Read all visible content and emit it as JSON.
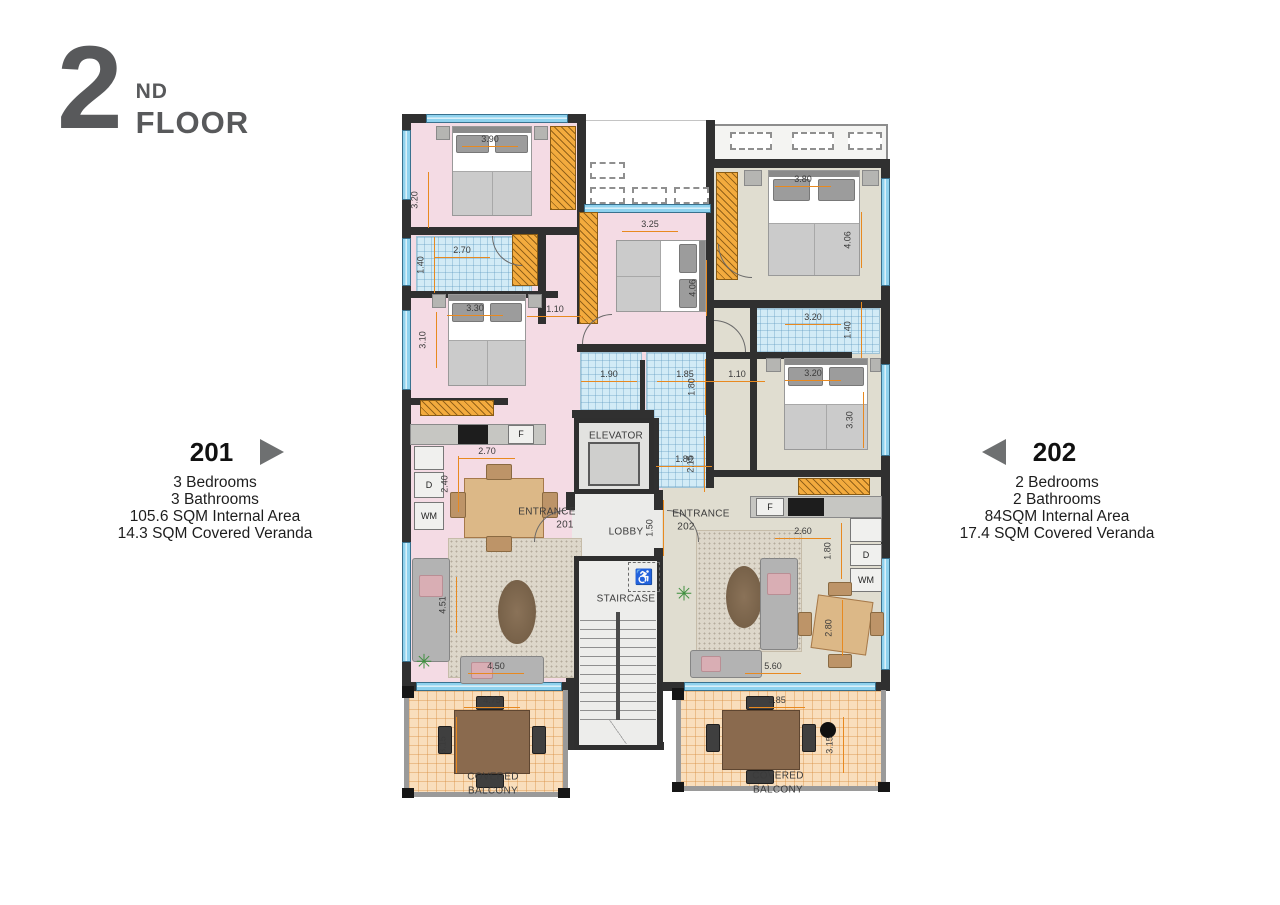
{
  "header": {
    "number": "2",
    "suffix": "ND",
    "word": "FLOOR"
  },
  "unit_left": {
    "number": "201",
    "bedrooms": "3 Bedrooms",
    "bathrooms": "3 Bathrooms",
    "internal": "105.6 SQM Internal Area",
    "veranda": "14.3 SQM Covered Veranda"
  },
  "unit_right": {
    "number": "202",
    "bedrooms": "2 Bedrooms",
    "bathrooms": "2 Bathrooms",
    "internal": "84SQM Internal Area",
    "veranda": "17.4 SQM Covered Veranda"
  },
  "plan": {
    "icons": {
      "wheelchair": "♿",
      "plant": "✳"
    },
    "room_labels": [
      {
        "t": "ELEVATOR",
        "x": 216,
        "y": 324
      },
      {
        "t": "LOBBY",
        "x": 226,
        "y": 420
      },
      {
        "t": "STAIRCASE",
        "x": 226,
        "y": 487
      },
      {
        "t": "ENTRANCE",
        "x": 147,
        "y": 400
      },
      {
        "t": "201",
        "x": 165,
        "y": 413
      },
      {
        "t": "ENTRANCE",
        "x": 301,
        "y": 402
      },
      {
        "t": "202",
        "x": 286,
        "y": 415
      },
      {
        "t": "COVERED",
        "x": 93,
        "y": 665
      },
      {
        "t": "BALCONY",
        "x": 93,
        "y": 679
      },
      {
        "t": "COVERED",
        "x": 378,
        "y": 664
      },
      {
        "t": "BALCONY",
        "x": 378,
        "y": 678
      }
    ],
    "appliance_labels": [
      {
        "t": "F",
        "x": 121,
        "y": 322
      },
      {
        "t": "D",
        "x": 29,
        "y": 373
      },
      {
        "t": "WM",
        "x": 29,
        "y": 404
      },
      {
        "t": "F",
        "x": 370,
        "y": 395
      },
      {
        "t": "D",
        "x": 466,
        "y": 443
      },
      {
        "t": "WM",
        "x": 466,
        "y": 468
      }
    ],
    "dimensions": [
      {
        "t": "3.90",
        "x": 90,
        "y": 32,
        "o": "h"
      },
      {
        "t": "3.20",
        "x": 25,
        "y": 88,
        "o": "v"
      },
      {
        "t": "2.70",
        "x": 62,
        "y": 143,
        "o": "h"
      },
      {
        "t": "1.40",
        "x": 31,
        "y": 153,
        "o": "v"
      },
      {
        "t": "3.30",
        "x": 75,
        "y": 201,
        "o": "h"
      },
      {
        "t": "3.10",
        "x": 33,
        "y": 228,
        "o": "v"
      },
      {
        "t": "1.10",
        "x": 155,
        "y": 202,
        "o": "h"
      },
      {
        "t": "3.25",
        "x": 250,
        "y": 117,
        "o": "h"
      },
      {
        "t": "4.06",
        "x": 303,
        "y": 176,
        "o": "v"
      },
      {
        "t": "1.90",
        "x": 209,
        "y": 267,
        "o": "h"
      },
      {
        "t": "1.85",
        "x": 285,
        "y": 267,
        "o": "h"
      },
      {
        "t": "1.80",
        "x": 302,
        "y": 275,
        "o": "v"
      },
      {
        "t": "1.80",
        "x": 284,
        "y": 352,
        "o": "h"
      },
      {
        "t": "2.15",
        "x": 301,
        "y": 352,
        "o": "v"
      },
      {
        "t": "2.70",
        "x": 87,
        "y": 344,
        "o": "h"
      },
      {
        "t": "2.40",
        "x": 55,
        "y": 372,
        "o": "v"
      },
      {
        "t": "4.51",
        "x": 53,
        "y": 493,
        "o": "v"
      },
      {
        "t": "4.50",
        "x": 96,
        "y": 559,
        "o": "h"
      },
      {
        "t": "1.50",
        "x": 260,
        "y": 416,
        "o": "v"
      },
      {
        "t": "4.75",
        "x": 92,
        "y": 593,
        "o": "h"
      },
      {
        "t": "3.15",
        "x": 53,
        "y": 633,
        "o": "v"
      },
      {
        "t": "3.80",
        "x": 403,
        "y": 72,
        "o": "h"
      },
      {
        "t": "4.06",
        "x": 458,
        "y": 128,
        "o": "v"
      },
      {
        "t": "3.20",
        "x": 413,
        "y": 210,
        "o": "h"
      },
      {
        "t": "1.40",
        "x": 458,
        "y": 218,
        "o": "v"
      },
      {
        "t": "3.20",
        "x": 413,
        "y": 266,
        "o": "h"
      },
      {
        "t": "3.30",
        "x": 460,
        "y": 308,
        "o": "v"
      },
      {
        "t": "1.10",
        "x": 337,
        "y": 267,
        "o": "h"
      },
      {
        "t": "2.60",
        "x": 403,
        "y": 424,
        "o": "h"
      },
      {
        "t": "1.80",
        "x": 438,
        "y": 439,
        "o": "v"
      },
      {
        "t": "2.80",
        "x": 439,
        "y": 516,
        "o": "v"
      },
      {
        "t": "5.60",
        "x": 373,
        "y": 559,
        "o": "h"
      },
      {
        "t": "5.85",
        "x": 377,
        "y": 593,
        "o": "h"
      },
      {
        "t": "3.15",
        "x": 440,
        "y": 633,
        "o": "v"
      }
    ]
  },
  "colors": {
    "title_gray": "#58595b",
    "triangle_gray": "#6e7071",
    "wall": "#303030",
    "apartment_201_floor": "#f4dbe4",
    "apartment_202_floor": "#e0ddd0",
    "bathroom_floor": "#d2ebf6",
    "balcony_floor": "#f9debc",
    "core_floor": "#ebebe9",
    "window_blue": "#8fd2ee",
    "wardrobe_orange": "#f3ab3e",
    "dimension_orange": "#e8891f"
  }
}
